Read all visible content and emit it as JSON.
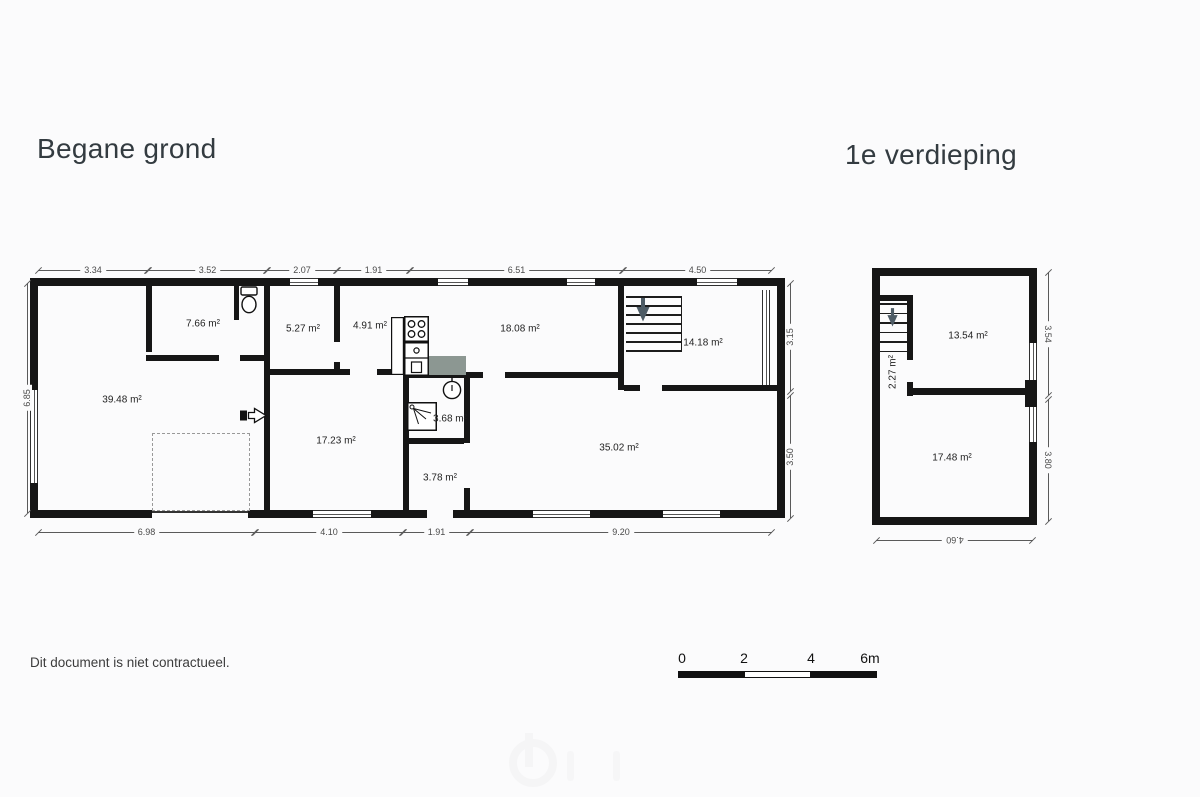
{
  "titles": {
    "ground": "Begane grond",
    "first": "1e verdieping"
  },
  "disclaimer": "Dit document is niet contractueel.",
  "scale_bar": {
    "labels": [
      "0",
      "2",
      "4",
      "6m"
    ]
  },
  "colors": {
    "wall": "#161616",
    "dim": "#5a5a5a",
    "label": "#1f1f1f",
    "arrow": "#4e5c66",
    "counter": "#8c9792"
  },
  "floors": [
    {
      "id": "begane-grond",
      "walls": [
        [
          30,
          278,
          260,
          8
        ],
        [
          318,
          278,
          120,
          8
        ],
        [
          468,
          278,
          99,
          8
        ],
        [
          595,
          278,
          102,
          8
        ],
        [
          737,
          278,
          48,
          8
        ],
        [
          30,
          510,
          122,
          8
        ],
        [
          248,
          510,
          65,
          8
        ],
        [
          371,
          510,
          56,
          8
        ],
        [
          453,
          510,
          80,
          8
        ],
        [
          590,
          510,
          73,
          8
        ],
        [
          720,
          510,
          65,
          8
        ],
        [
          30,
          278,
          8,
          112
        ],
        [
          30,
          483,
          8,
          35
        ],
        [
          777,
          278,
          8,
          240
        ],
        [
          146,
          283,
          6,
          69
        ],
        [
          146,
          355,
          73,
          6
        ],
        [
          240,
          355,
          30,
          6
        ],
        [
          234,
          283,
          5,
          37
        ],
        [
          264,
          283,
          6,
          227
        ],
        [
          334,
          283,
          6,
          59
        ],
        [
          334,
          362,
          6,
          13
        ],
        [
          270,
          369,
          80,
          6
        ],
        [
          377,
          369,
          27,
          6
        ],
        [
          403,
          375,
          6,
          135
        ],
        [
          464,
          378,
          6,
          65
        ],
        [
          464,
          488,
          6,
          22
        ],
        [
          409,
          438,
          55,
          6
        ],
        [
          409,
          372,
          74,
          6
        ],
        [
          505,
          372,
          113,
          6
        ],
        [
          618,
          283,
          6,
          107
        ],
        [
          624,
          385,
          16,
          6
        ],
        [
          662,
          385,
          115,
          6
        ]
      ],
      "windows": [
        [
          290,
          278,
          28,
          8
        ],
        [
          438,
          278,
          30,
          8
        ],
        [
          567,
          278,
          28,
          8
        ],
        [
          697,
          278,
          40,
          8
        ],
        [
          313,
          510,
          58,
          8
        ],
        [
          533,
          510,
          57,
          8
        ],
        [
          663,
          510,
          57,
          8
        ],
        [
          30,
          390,
          8,
          93
        ],
        [
          762,
          290,
          8,
          95
        ]
      ],
      "thin": [
        [
          152,
          511,
          96,
          2
        ]
      ],
      "dashed": [
        [
          152,
          433,
          98,
          78
        ]
      ],
      "stairs": [
        {
          "x": 626,
          "y": 296,
          "w": 56,
          "steps": 7,
          "gap": 9,
          "rail": true,
          "ax": 636,
          "ay": 298,
          "aw": 14,
          "ah": 24
        }
      ],
      "rooms": [
        {
          "t": "7.66 m²",
          "x": 203,
          "y": 324
        },
        {
          "t": "5.27 m²",
          "x": 303,
          "y": 329
        },
        {
          "t": "4.91 m²",
          "x": 370,
          "y": 326
        },
        {
          "t": "18.08 m²",
          "x": 520,
          "y": 329
        },
        {
          "t": "14.18 m²",
          "x": 703,
          "y": 343
        },
        {
          "t": "39.48 m²",
          "x": 122,
          "y": 400
        },
        {
          "t": "17.23 m²",
          "x": 336,
          "y": 441
        },
        {
          "t": "3.68 m²",
          "x": 450,
          "y": 419
        },
        {
          "t": "35.02 m²",
          "x": 619,
          "y": 448
        },
        {
          "t": "3.78 m²",
          "x": 440,
          "y": 478
        }
      ],
      "dims": [
        {
          "t": "3.34",
          "o": "h",
          "a": 38,
          "b": 148,
          "p": 270
        },
        {
          "t": "3.52",
          "o": "h",
          "a": 148,
          "b": 267,
          "p": 270
        },
        {
          "t": "2.07",
          "o": "h",
          "a": 267,
          "b": 337,
          "p": 270
        },
        {
          "t": "1.91",
          "o": "h",
          "a": 337,
          "b": 410,
          "p": 270
        },
        {
          "t": "6.51",
          "o": "h",
          "a": 410,
          "b": 623,
          "p": 270
        },
        {
          "t": "4.50",
          "o": "h",
          "a": 623,
          "b": 772,
          "p": 270
        },
        {
          "t": "6.98",
          "o": "h",
          "a": 38,
          "b": 255,
          "p": 532
        },
        {
          "t": "4.10",
          "o": "h",
          "a": 255,
          "b": 403,
          "p": 532
        },
        {
          "t": "1.91",
          "o": "h",
          "a": 403,
          "b": 470,
          "p": 532
        },
        {
          "t": "9.20",
          "o": "h",
          "a": 470,
          "b": 772,
          "p": 532
        },
        {
          "t": "6.85",
          "o": "v",
          "a": 283,
          "b": 513,
          "p": 27,
          "rot": -90
        },
        {
          "t": "3.15",
          "o": "v",
          "a": 283,
          "b": 391,
          "p": 790,
          "rot": -90
        },
        {
          "t": "3.50",
          "o": "v",
          "a": 395,
          "b": 518,
          "p": 790,
          "rot": -90
        }
      ],
      "fixtures": [
        {
          "type": "toilet",
          "x": 239,
          "y": 286
        },
        {
          "type": "cabinet",
          "x": 391,
          "y": 317
        },
        {
          "type": "stove",
          "x": 404,
          "y": 316
        },
        {
          "type": "sink-cabinet",
          "x": 404,
          "y": 342
        },
        {
          "type": "counter",
          "x": 429,
          "y": 356
        },
        {
          "type": "basin",
          "x": 441,
          "y": 377
        },
        {
          "type": "shower",
          "x": 407,
          "y": 402
        },
        {
          "type": "entry-arrow",
          "x": 240,
          "y": 407
        }
      ]
    },
    {
      "id": "eerste-verdieping",
      "walls": [
        [
          872,
          268,
          165,
          8
        ],
        [
          872,
          268,
          8,
          257
        ],
        [
          872,
          517,
          165,
          8
        ],
        [
          1029,
          268,
          8,
          75
        ],
        [
          1025,
          380,
          12,
          27
        ],
        [
          1029,
          442,
          8,
          83
        ],
        [
          880,
          295,
          33,
          6
        ],
        [
          907,
          295,
          6,
          65
        ],
        [
          907,
          382,
          6,
          14
        ],
        [
          907,
          388,
          122,
          7
        ]
      ],
      "windows": [
        [
          1029,
          343,
          8,
          37
        ],
        [
          1029,
          407,
          8,
          35
        ]
      ],
      "thin": [],
      "dashed": [],
      "stairs": [
        {
          "x": 880,
          "y": 303,
          "w": 27,
          "steps": 6,
          "gap": 9.5,
          "rail": false,
          "ax": 887,
          "ay": 308,
          "aw": 11,
          "ah": 19
        }
      ],
      "rooms": [
        {
          "t": "13.54 m²",
          "x": 968,
          "y": 336
        },
        {
          "t": "2.27 m²",
          "x": 893,
          "y": 372,
          "rot": -90
        },
        {
          "t": "17.48 m²",
          "x": 952,
          "y": 458
        }
      ],
      "dims": [
        {
          "t": "3.54",
          "o": "v",
          "a": 272,
          "b": 395,
          "p": 1048,
          "rot": 90
        },
        {
          "t": "3.80",
          "o": "v",
          "a": 399,
          "b": 521,
          "p": 1048,
          "rot": 90
        },
        {
          "t": "4.60",
          "o": "h",
          "a": 876,
          "b": 1033,
          "p": 540,
          "rot": 180
        }
      ],
      "fixtures": []
    }
  ]
}
